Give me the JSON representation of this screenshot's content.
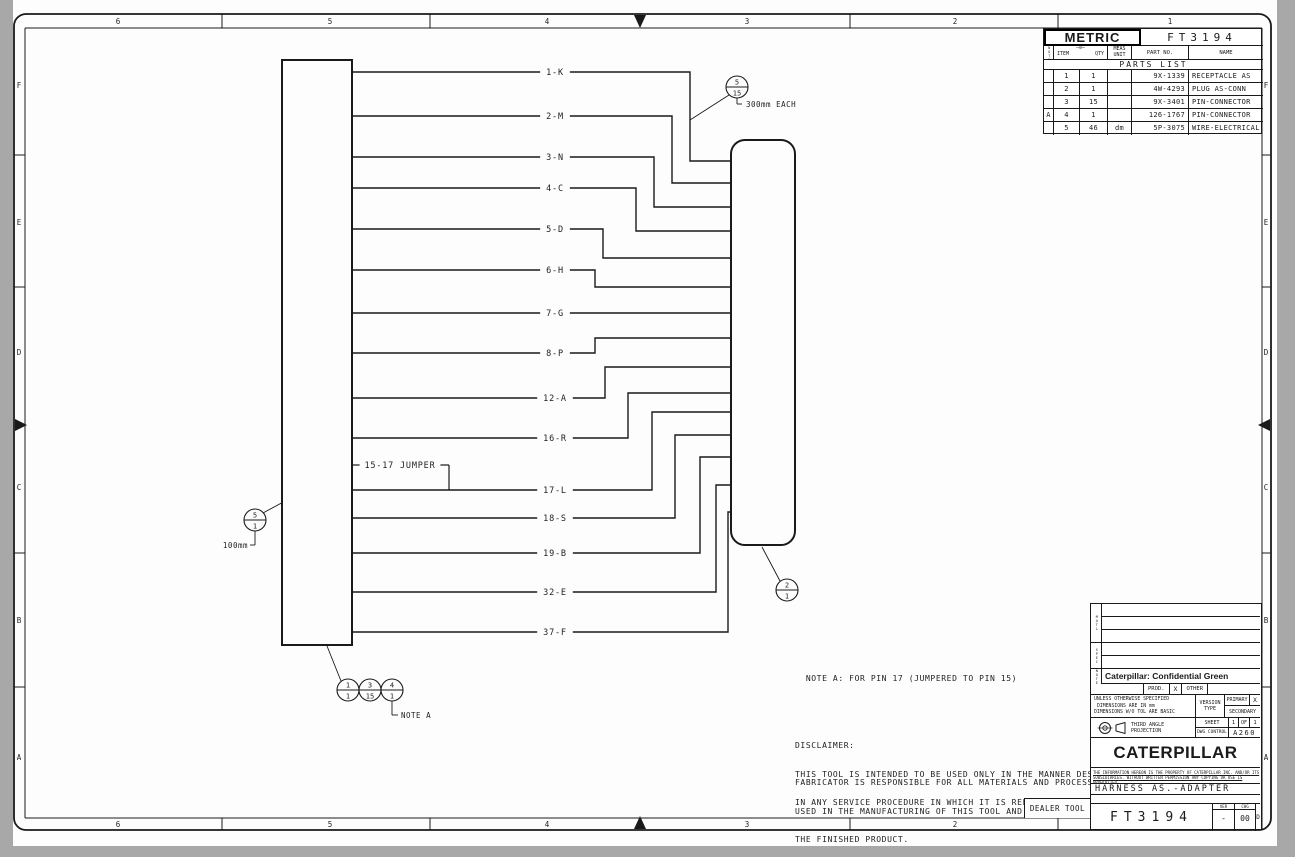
{
  "drawing_number": "FT3194",
  "sheet": {
    "zones_top": [
      "6",
      "5",
      "4",
      "3",
      "2",
      "1"
    ],
    "zones_bottom": [
      "6",
      "5",
      "4",
      "3",
      "2"
    ],
    "zones_left": [
      "F",
      "E",
      "D",
      "C",
      "B",
      "A"
    ],
    "zones_right": [
      "F",
      "E",
      "D",
      "C",
      "B",
      "A"
    ]
  },
  "parts_table": {
    "metric_label": "METRIC",
    "note_col_header": "NOTE",
    "item_header": "ITEM",
    "qty_header": "QTY",
    "meas_header": "MEAS",
    "unit_header": "UNIT",
    "part_no_header": "PART NO.",
    "name_header": "NAME",
    "title": "PARTS LIST",
    "rows": [
      {
        "note": "",
        "item": "1",
        "qty": "1",
        "unit": "",
        "part": "9X-1339",
        "name": "RECEPTACLE AS"
      },
      {
        "note": "",
        "item": "2",
        "qty": "1",
        "unit": "",
        "part": "4W-4293",
        "name": "PLUG AS-CONN"
      },
      {
        "note": "",
        "item": "3",
        "qty": "15",
        "unit": "",
        "part": "9X-3401",
        "name": "PIN-CONNECTOR"
      },
      {
        "note": "A",
        "item": "4",
        "qty": "1",
        "unit": "",
        "part": "126-1767",
        "name": "PIN-CONNECTOR"
      },
      {
        "note": "",
        "item": "5",
        "qty": "46",
        "unit": "dm",
        "part": "5P-3075",
        "name": "WIRE-ELECTRICAL"
      }
    ]
  },
  "diagram": {
    "receptacle_box": {
      "x": 282,
      "y": 60,
      "w": 70,
      "h": 585
    },
    "plug_box": {
      "x": 731,
      "y": 140,
      "w": 64,
      "h": 405,
      "r": 14
    },
    "wire_label_center_x": 555,
    "wires": [
      {
        "label": "1-K",
        "y": 72,
        "turn_x": 690,
        "entry_y": 161
      },
      {
        "label": "2-M",
        "y": 116,
        "turn_x": 672,
        "entry_y": 183
      },
      {
        "label": "3-N",
        "y": 157,
        "turn_x": 654,
        "entry_y": 207
      },
      {
        "label": "4-C",
        "y": 188,
        "turn_x": 636,
        "entry_y": 231
      },
      {
        "label": "5-D",
        "y": 229,
        "turn_x": 603,
        "entry_y": 258
      },
      {
        "label": "6-H",
        "y": 270,
        "turn_x": 595,
        "entry_y": 287
      },
      {
        "label": "7-G",
        "y": 313,
        "turn_x": null,
        "entry_y": 313
      },
      {
        "label": "8-P",
        "y": 353,
        "turn_x": 595,
        "entry_y": 338
      },
      {
        "label": "12-A",
        "y": 398,
        "turn_x": 605,
        "entry_y": 367
      },
      {
        "label": "16-R",
        "y": 438,
        "turn_x": 628,
        "entry_y": 393
      },
      {
        "label": "17-L",
        "y": 490,
        "turn_x": 652,
        "entry_y": 412
      },
      {
        "label": "18-S",
        "y": 518,
        "turn_x": 675,
        "entry_y": 435
      },
      {
        "label": "19-B",
        "y": 553,
        "turn_x": 700,
        "entry_y": 457
      },
      {
        "label": "32-E",
        "y": 592,
        "turn_x": 716,
        "entry_y": 485
      },
      {
        "label": "37-F",
        "y": 632,
        "turn_x": 728,
        "entry_y": 512
      }
    ],
    "jumper": {
      "label": "15-17 JUMPER",
      "y": 465,
      "drop_x": 449,
      "join_y": 490,
      "center_x": 400
    },
    "balloons": [
      {
        "cx": 737,
        "cy": 87,
        "top": "5",
        "bottom": "15",
        "leader": [
          729,
          95,
          690,
          120
        ],
        "tail_lines": [
          [
            737,
            98,
            737,
            104
          ],
          [
            737,
            104,
            742,
            104
          ]
        ],
        "tail_text": "300mm EACH",
        "tx": 746,
        "ty": 107,
        "anchor": "start"
      },
      {
        "cx": 255,
        "cy": 520,
        "top": "5",
        "bottom": "1",
        "leader": [
          263,
          513,
          348,
          467
        ],
        "tail_lines": [
          [
            255,
            531,
            255,
            545
          ],
          [
            255,
            545,
            250,
            545
          ]
        ],
        "tail_text": "100mm",
        "tx": 248,
        "ty": 548,
        "anchor": "end"
      },
      {
        "cx": 787,
        "cy": 590,
        "top": "2",
        "bottom": "1",
        "leader": [
          780,
          581,
          762,
          547
        ]
      },
      {
        "cx": 348,
        "cy": 690,
        "top": "1",
        "bottom": "1",
        "leader": [
          341,
          681,
          327,
          646
        ]
      },
      {
        "cx": 370,
        "cy": 690,
        "top": "3",
        "bottom": "15"
      },
      {
        "cx": 392,
        "cy": 690,
        "top": "4",
        "bottom": "1",
        "tail_lines": [
          [
            392,
            701,
            392,
            715
          ],
          [
            392,
            715,
            398,
            715
          ]
        ],
        "tail_text": "NOTE A",
        "tx": 401,
        "ty": 718,
        "anchor": "start"
      }
    ]
  },
  "notes": {
    "note_a": "NOTE A: FOR PIN 17 (JUMPERED TO PIN 15)",
    "disclaimer_title": "DISCLAIMER:",
    "disclaimer_line1": "THIS TOOL IS INTENDED TO BE USED ONLY IN THE MANNER DESCRIBED",
    "disclaimer_line2": "IN ANY SERVICE PROCEDURE IN WHICH IT IS REFERENCED.",
    "fabricator_line1": "FABRICATOR IS RESPONSIBLE FOR ALL MATERIALS AND PROCESSES",
    "fabricator_line2": "USED IN THE MANUFACTURING OF THIS TOOL AND FOR THE QUALITY OF",
    "fabricator_line3": "THE FINISHED PRODUCT."
  },
  "title_block": {
    "matl_label": "MATL",
    "spec_label": "SPEC",
    "note_label": "NOTE",
    "confidential": "Caterpillar: Confidential Green",
    "prod_label": "PROD.",
    "prod_x": "X",
    "other_label": "OTHER",
    "unless_line1": "UNLESS OTHERWISE SPECIFIED",
    "unless_line2": "DIMENSIONS ARE IN mm",
    "unless_line3": "DIMENSIONS W/O TOL ARE BASIC",
    "version_line1": "VERSION",
    "version_line2": "TYPE",
    "primary_label": "PRIMARY",
    "primary_x": "X",
    "secondary_label": "SECONDARY",
    "projection_line1": "THIRD ANGLE",
    "projection_line2": "PROJECTION",
    "sheet_label": "SHEET",
    "sheet_no": "1",
    "of_label": "OF",
    "of_no": "1",
    "dwg_control_label": "DWG CONTROL",
    "dwg_control_value": "A260",
    "logo": "CATERPILLAR",
    "legal_line1": "THE INFORMATION HEREON IS THE PROPERTY OF CATERPILLAR INC. AND/OR ITS",
    "legal_line2": "SUBSIDIARIES. WITHOUT WRITTEN PERMISSION ANY COPYING OR USE IS PROHIBITED.",
    "title": "HARNESS AS.-ADAPTER",
    "ver_label": "VER",
    "ver_value": "-",
    "chg_label": "CHG",
    "chg_value": "00",
    "size": "D",
    "dealer_tool_label": "DEALER TOOL"
  }
}
